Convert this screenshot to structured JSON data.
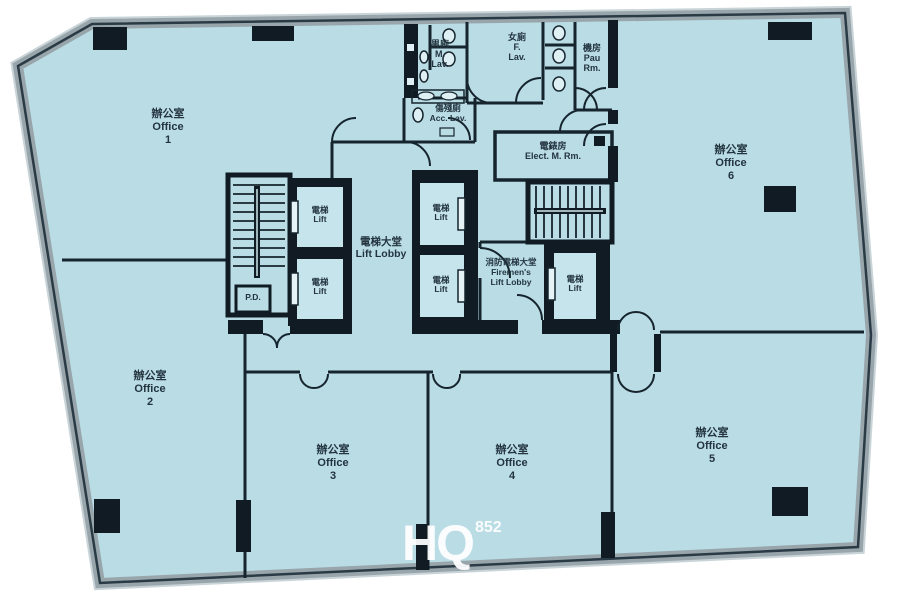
{
  "page": {
    "type": "building-floor-plan"
  },
  "watermark": {
    "main": "HQ",
    "sub": "852"
  },
  "labels": {
    "office1": {
      "zh": "辦公室",
      "en": "Office",
      "num": "1"
    },
    "office2": {
      "zh": "辦公室",
      "en": "Office",
      "num": "2"
    },
    "office3": {
      "zh": "辦公室",
      "en": "Office",
      "num": "3"
    },
    "office4": {
      "zh": "辦公室",
      "en": "Office",
      "num": "4"
    },
    "office5": {
      "zh": "辦公室",
      "en": "Office",
      "num": "5"
    },
    "office6": {
      "zh": "辦公室",
      "en": "Office",
      "num": "6"
    },
    "lift_lobby": {
      "zh": "電梯大堂",
      "en": "Lift Lobby"
    },
    "lift": {
      "zh": "電梯",
      "en": "Lift"
    },
    "firemens_lift_lobby": {
      "zh": "消防電梯大堂",
      "en_line1": "Firemen's",
      "en_line2": "Lift Lobby"
    },
    "male_lavatory": {
      "zh": "男廁",
      "en_line1": "M.",
      "en_line2": "Lav."
    },
    "female_lavatory": {
      "zh": "女廁",
      "en_line1": "F.",
      "en_line2": "Lav."
    },
    "pau_room": {
      "zh": "機房",
      "en_line1": "Pau",
      "en_line2": "Rm."
    },
    "accessible_lavatory": {
      "zh": "傷殘廁",
      "en": "Acc. Lav."
    },
    "electrical_meter_room": {
      "zh": "電錶房",
      "en": "Elect. M. Rm."
    },
    "pipe_duct": "P.D."
  },
  "colors": {
    "floor": "#b9dce5",
    "lift_car": "#c6e4ec",
    "wall": "#101b24",
    "outer_band": "#98a6ac",
    "label_text": "#23343f",
    "watermark": "#ffffff",
    "background": "#ffffff"
  }
}
